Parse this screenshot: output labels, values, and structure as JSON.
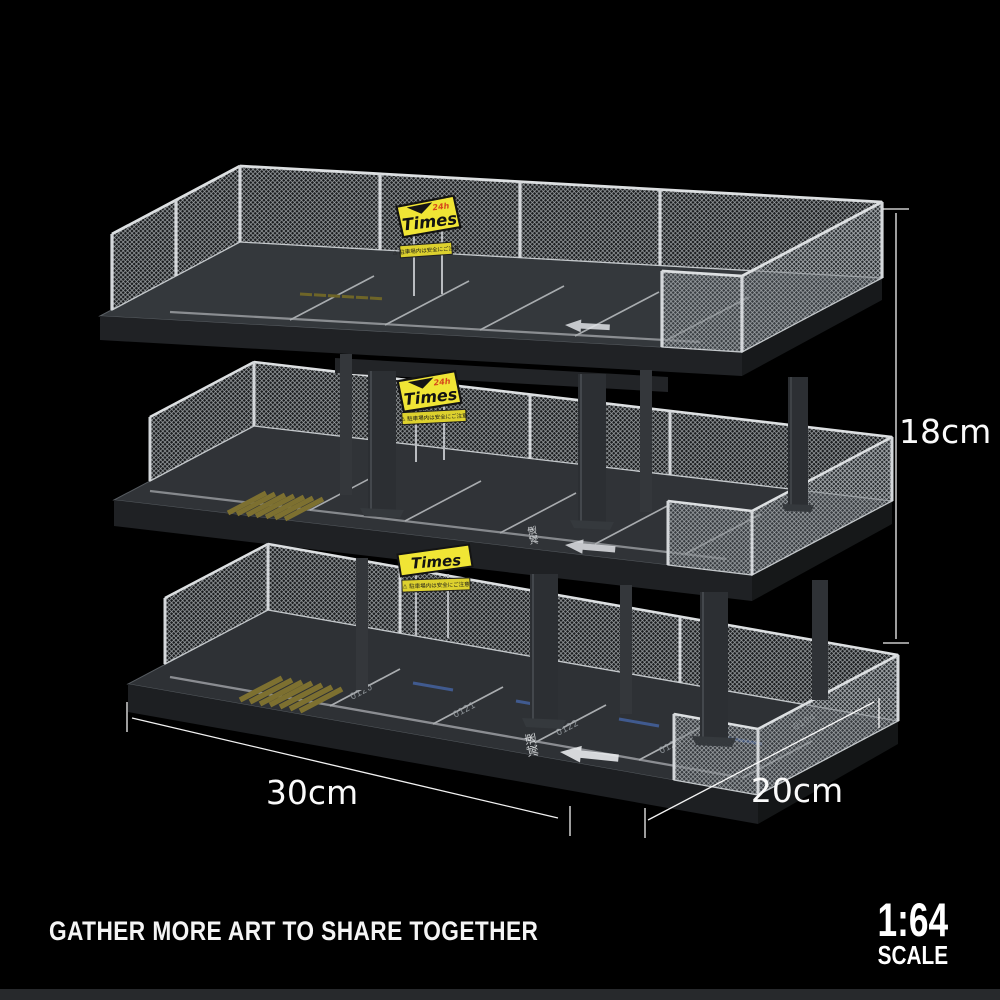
{
  "dimensions": {
    "height_label": "18cm",
    "width_label": "30cm",
    "depth_label": "20cm"
  },
  "signs": {
    "brand": "Times",
    "hours": "24h",
    "warning_text": "⚠ 駐車場内は安全にご注意"
  },
  "markings": {
    "stall_numbers": [
      "0120",
      "0121",
      "0122",
      "0123",
      "0104"
    ],
    "road_text": "减速",
    "arrow_direction": "left"
  },
  "footer": {
    "caption": "GATHER MORE ART TO SHARE TOGETHER",
    "scale_ratio": "1:64",
    "scale_word": "SCALE"
  },
  "colors": {
    "background": "#000000",
    "footer_bar": "#27292c",
    "deck_surface": "#303438",
    "deck_face": "#1e2023",
    "fence_metal": "#c3c7ca",
    "pillar": "#2c2f33",
    "sign_yellow": "#f0e535",
    "sign_strip_yellow": "#ddd12e",
    "sign_border": "#141414",
    "sign_text": "#131313",
    "sign_24h_red": "#d6481c",
    "marking_white": "#e8eaec",
    "hatch_olive": "#7d7030",
    "wheel_stop_blue": "#44629f",
    "stall_number_gray": "#9aa0a5",
    "dimension_text": "#ffffff"
  }
}
